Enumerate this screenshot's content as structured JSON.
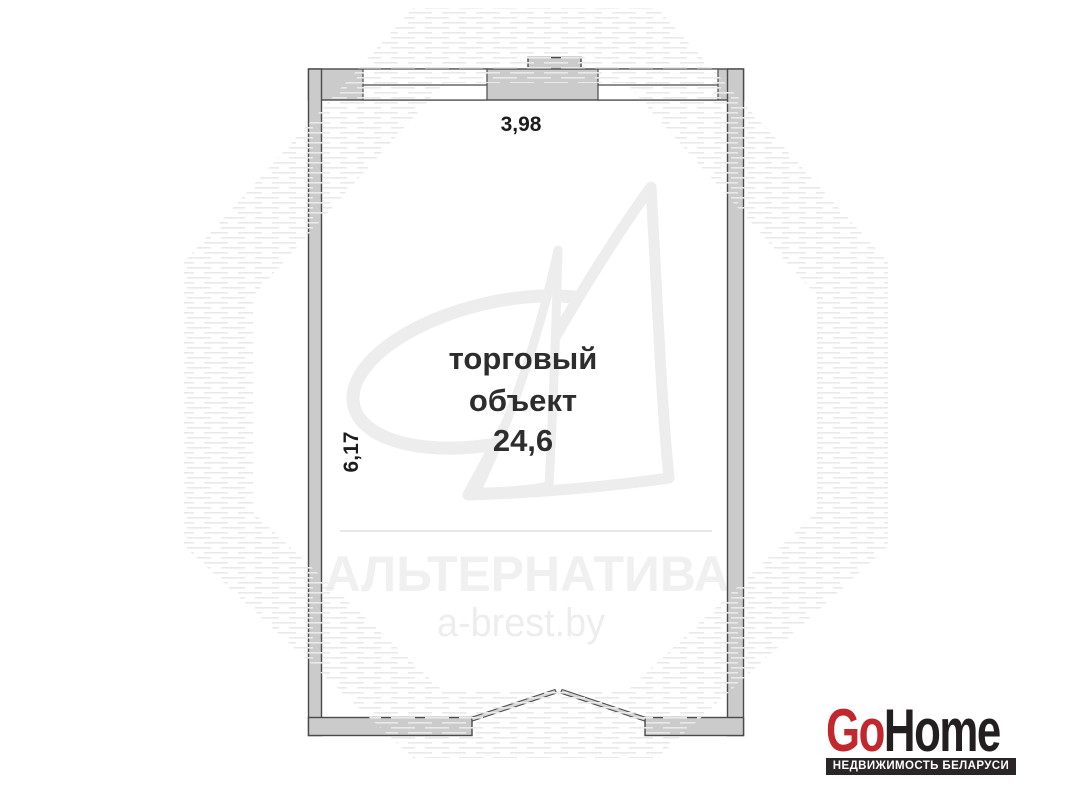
{
  "plan": {
    "room": {
      "label_line1": "торговый",
      "label_line2": "объект",
      "area": "24,6"
    },
    "dimensions": {
      "width": "3,98",
      "height": "6,17"
    }
  },
  "watermark": {
    "agency": "АЛЬТЕРНАТИВА",
    "site": "a-brest.by"
  },
  "branding": {
    "logo_part1": "Go",
    "logo_part2": "Home",
    "tagline": "НЕДВИЖИМОСТЬ БЕЛАРУСИ",
    "logo_red": "#c1272d",
    "logo_dark": "#231f20",
    "tagline_bg": "#2a2627"
  },
  "colors": {
    "wall_fill": "#cbcbcb",
    "wall_stroke": "#4a4a4a",
    "watermark_gray": "#efefef"
  }
}
